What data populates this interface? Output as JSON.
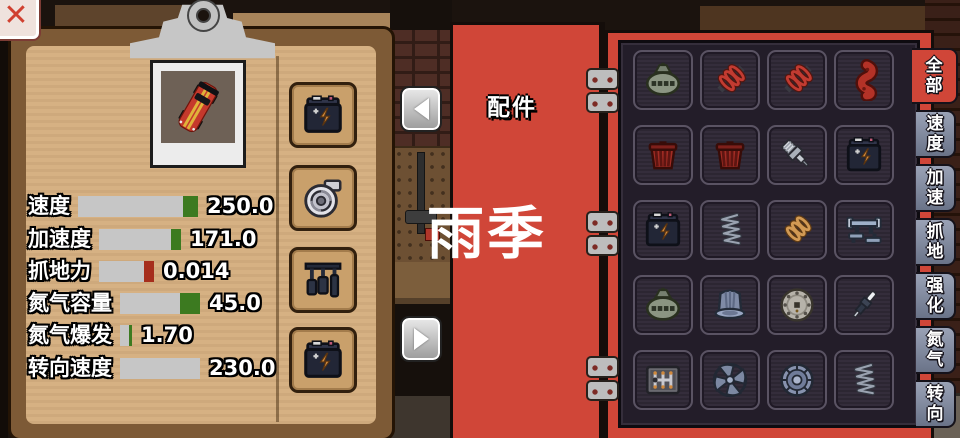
{
  "colors": {
    "accent_red": "#d04638",
    "panel_dark": "#231d29",
    "paper_tan": "#d6b183",
    "bar_gray": "#c6c6c6",
    "cap_green": "#3c7a20",
    "cap_red": "#a62e1c",
    "tab_inactive": "#7e879c"
  },
  "close_button": {
    "label": "✕"
  },
  "clipboard": {
    "vehicle_icon": "car",
    "stats": [
      {
        "label": "速度",
        "value": "250.0",
        "bar_width": 120,
        "cap_width": 15,
        "cap_color": "#3c7a20"
      },
      {
        "label": "加速度",
        "value": "171.0",
        "bar_width": 82,
        "cap_width": 10,
        "cap_color": "#3c7a20"
      },
      {
        "label": "抓地力",
        "value": "0.014",
        "bar_width": 55,
        "cap_width": 10,
        "cap_color": "#a62e1c"
      },
      {
        "label": "氮气容量",
        "value": "45.0",
        "bar_width": 80,
        "cap_width": 20,
        "cap_color": "#3c7a20"
      },
      {
        "label": "氮气爆发",
        "value": "1.70",
        "bar_width": 12,
        "cap_width": 3,
        "cap_color": "#3c7a20"
      },
      {
        "label": "转向速度",
        "value": "230.0",
        "bar_width": 80,
        "cap_width": 0,
        "cap_color": "transparent"
      }
    ],
    "equipped_slots": [
      {
        "icon": "battery"
      },
      {
        "icon": "turbocharger"
      },
      {
        "icon": "pedals"
      },
      {
        "icon": "battery"
      }
    ]
  },
  "nav": {
    "prev_icon": "left-triangle",
    "next_icon": "right-triangle"
  },
  "book": {
    "title": "配件"
  },
  "season_overlay": {
    "label": "雨季"
  },
  "parts_grid": {
    "items": [
      {
        "icon": "supercharger"
      },
      {
        "icon": "coil-spring-red"
      },
      {
        "icon": "coil-spring-red"
      },
      {
        "icon": "crankshaft-red"
      },
      {
        "icon": "air-filter-red"
      },
      {
        "icon": "air-filter-red"
      },
      {
        "icon": "spark-plug"
      },
      {
        "icon": "battery"
      },
      {
        "icon": "battery"
      },
      {
        "icon": "wire-spring"
      },
      {
        "icon": "coil-spring-orange"
      },
      {
        "icon": "sway-bar"
      },
      {
        "icon": "supercharger"
      },
      {
        "icon": "clutch-bell"
      },
      {
        "icon": "clutch-disc"
      },
      {
        "icon": "spark-plug-diagonal"
      },
      {
        "icon": "gear-shifter"
      },
      {
        "icon": "radiator-fan"
      },
      {
        "icon": "flywheel"
      },
      {
        "icon": "wire-spring"
      }
    ]
  },
  "category_tabs": [
    {
      "label": "全部",
      "selected": true
    },
    {
      "label": "速度",
      "selected": false
    },
    {
      "label": "加速",
      "selected": false
    },
    {
      "label": "抓地",
      "selected": false
    },
    {
      "label": "强化",
      "selected": false
    },
    {
      "label": "氮气",
      "selected": false
    },
    {
      "label": "转向",
      "selected": false
    }
  ]
}
